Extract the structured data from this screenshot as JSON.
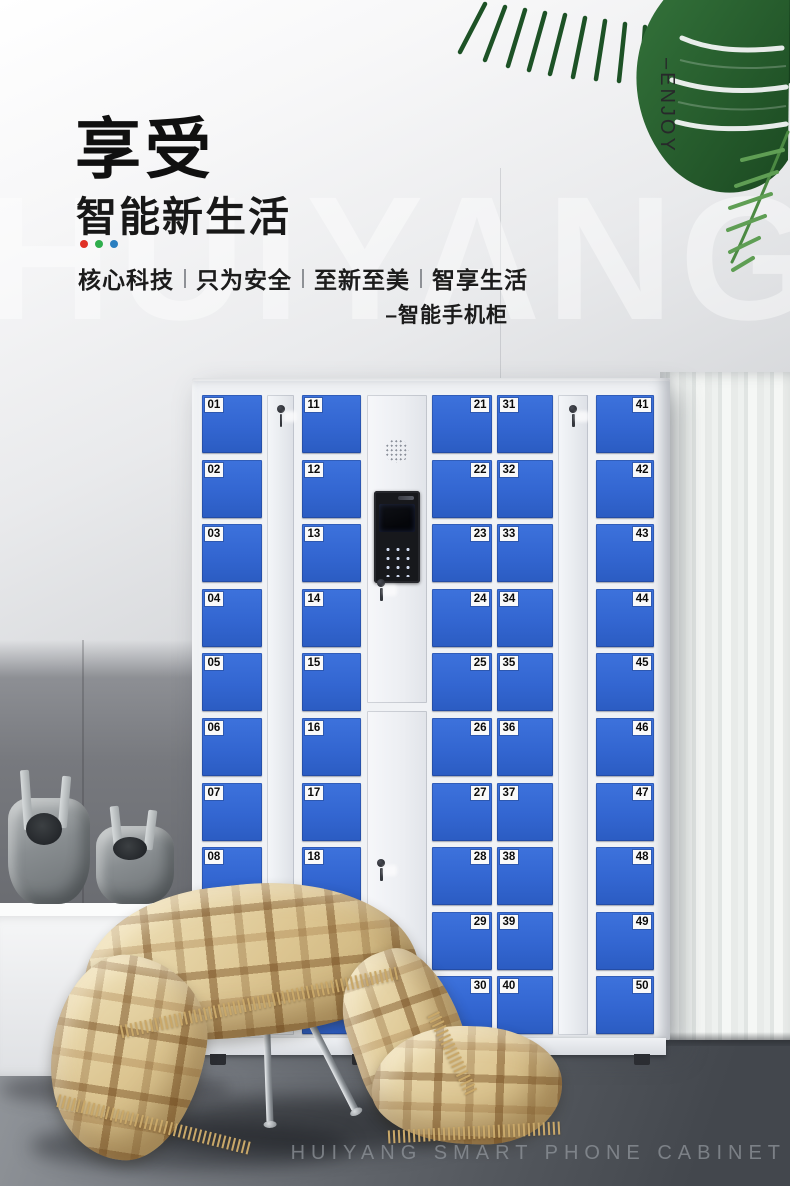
{
  "header": {
    "title": "享受",
    "subtitle": "智能新生活",
    "dot_colors": [
      "#e03026",
      "#2fae4d",
      "#2b7fc0"
    ],
    "tagline_items": [
      "核心科技",
      "只为安全",
      "至新至美",
      "智享生活"
    ],
    "product_label": "–智能手机柜",
    "enjoy_vertical": "–ENJOY"
  },
  "watermark": "HUIYANG",
  "caption": "HUIYANG SMART PHONE CABINET",
  "locker": {
    "door_color": "#3366d1",
    "columns": [
      {
        "type": "doors",
        "label_side": "left",
        "numbers": [
          "01",
          "02",
          "03",
          "04",
          "05",
          "06",
          "07",
          "08",
          "09",
          "10"
        ]
      },
      {
        "type": "lock",
        "icon": "keyhole-icon"
      },
      {
        "type": "doors",
        "label_side": "left",
        "numbers": [
          "11",
          "12",
          "13",
          "14",
          "15",
          "16",
          "17",
          "18",
          "19",
          "20"
        ]
      },
      {
        "type": "panel",
        "icons": [
          "speaker-icon",
          "camera-lens-icon",
          "screen",
          "keypad",
          "keyhole-icon"
        ]
      },
      {
        "type": "doors",
        "label_side": "right",
        "numbers": [
          "21",
          "22",
          "23",
          "24",
          "25",
          "26",
          "27",
          "28",
          "29",
          "30"
        ]
      },
      {
        "type": "doors",
        "label_side": "left",
        "numbers": [
          "31",
          "32",
          "33",
          "34",
          "35",
          "36",
          "37",
          "38",
          "39",
          "40"
        ]
      },
      {
        "type": "lock",
        "icon": "keyhole-icon"
      },
      {
        "type": "doors",
        "label_side": "right",
        "numbers": [
          "41",
          "42",
          "43",
          "44",
          "45",
          "46",
          "47",
          "48",
          "49",
          "50"
        ]
      }
    ]
  }
}
